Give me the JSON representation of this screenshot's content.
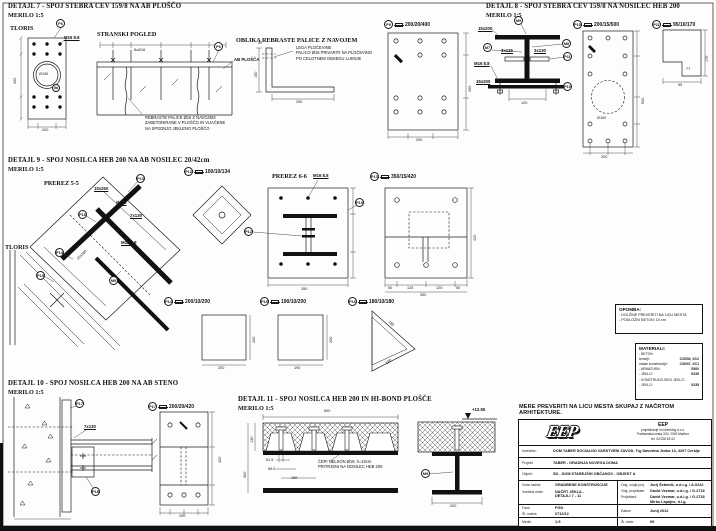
{
  "sheet": {
    "note_bold": "MERE PREVERITI NA LICU MESTA SKUPAJ Z NAČRTOM ARHITEKTURE.",
    "opomba": {
      "title": "OPOMBA:",
      "line1": "- DOLŽINE PREVERITI NA LICU MESTA",
      "line2": "- PODLOŽNI BETON: 10 cm"
    },
    "materiali": {
      "title": "MATERIALI:",
      "rows": [
        {
          "k": "- BETON",
          "v": ""
        },
        {
          "k": "temelji:",
          "v": "C25/30, XC2"
        },
        {
          "k": "ostale konstrukcije:",
          "v": "C30/37, XC1"
        },
        {
          "k": "- ARMATURA:",
          "v": "S500"
        },
        {
          "k": "- JEKLO:",
          "v": "S235"
        },
        {
          "k": "- KONSTRUKCIJSKO JEKLO:",
          "v": ""
        },
        {
          "k": "- JEKLO:",
          "v": "S235"
        }
      ]
    }
  },
  "d7": {
    "title": "DETAJL 7 - SPOJ STEBRA CEV 159/8 NA AB PLOŠČO",
    "scale": "MERILO 1:5",
    "tloris": "TLORIS",
    "stranski": "STRANSKI POGLED",
    "oblika": "OBLIKA REBRASTE PALICE Z NAVOJEM",
    "bolt": "M16 8.8",
    "cev": "Ø159",
    "bars": "8xØ16",
    "ab_plosca": "AB PLOŠČA",
    "note_rebraste": "REBRASTE PALICE Ø16 Z NAVOJEM\nZABETONIRANE V PLOŠČO IN VIJAČENE\nNA SPODNJO JEKLENO PLOŠČO",
    "note_lega": "LEGA PLOČEVINE\nPALICO Ø16 PRIVARITI NA PLOČEVINO\nPO CELOTNEM OBSEGU LUKNJE",
    "tag_p6": "P6",
    "tag_5a": "5a",
    "tag_p9": "P9",
    "p9_size": "200/20/400",
    "dim_w": "200",
    "dim_h": "400",
    "dim_250": "250",
    "dim_150": "150",
    "dim_50": "50",
    "p9_w": "200",
    "p9_h": "400"
  },
  "d8": {
    "title": "DETAJL 8 - SPOJ STEBRA CEV 159/8 NA NOSILEC HEB 200",
    "scale": "MERILO 1:5",
    "weld_top": "15x200",
    "weld_bot": "15x200",
    "s135": "3x135",
    "s130": "3x130",
    "bolt": "M16 8.8",
    "dim_120": "120",
    "tag_m9": "M9",
    "tag_m7": "M7",
    "tag_m8": "M8",
    "tag_p10": "P10",
    "tag_p11": "P11",
    "p10_size": "200/15/500",
    "p11_size": "95/10/170",
    "hole": "Ø160",
    "p10_w": "200",
    "p10_h": "500",
    "p11_w": "95",
    "p11_h": "170",
    "p11_s": "77"
  },
  "d9": {
    "title": "DETAJL 9 - SPOJ NOSILCA HEB 200 NA AB NOSILEC 20/42cm",
    "scale": "MERILO 1:5",
    "prerez55": "PREREZ 5-5",
    "tloris": "TLORIS",
    "prerez66": "PREREZ 6-6",
    "lab_10x250": "10x250",
    "lab_o150": "Ø150",
    "lab_7x130": "7x130",
    "lab_m12": "M12 8.8",
    "lab_10x160": "10x160",
    "bolt": "M16 8.8",
    "tag_p12": "P12",
    "tag_p13": "P13",
    "tag_p14": "P14",
    "tag_p15": "P15",
    "tag_p16": "P16",
    "tag_m9": "M9",
    "p12_size": "100/10/134",
    "p13_size": "350/15/420",
    "p14_size": "200/10/200",
    "p15_size": "190/10/200",
    "p16_size": "180/10/180",
    "dim66_w": "350",
    "p13_chain": [
      "50",
      "125",
      "125",
      "50"
    ],
    "p13_w": "350",
    "p13_h": "420",
    "p14_w": "200",
    "p14_h": "200",
    "p15_w": "190",
    "p15_h": "200",
    "p16_a": "180",
    "p16_b": "180"
  },
  "d10": {
    "title": "DETAJL 10 - SPOJ NOSILCA HEB 200 NA AB STENO",
    "scale": "MERILO 1:5",
    "tag_p17": "P17",
    "tag_p18": "P18",
    "lab_7x130": "7x130",
    "p17_size": "200/20/420",
    "p17_w": "200",
    "p17_h": "420"
  },
  "d11": {
    "title": "DETAJL 11 - SPOJ NOSILCA HEB 200 IN HI-BOND PLOŠČE",
    "scale": "MERILO 1:5",
    "note_cepi": "ČEPI NELSON Ø19, h=10cm\nPRITRJENI NA NOSILEC HEB 200",
    "elev": "+12.50",
    "tag_m9": "M9",
    "dim_600": "600",
    "dim_61": "61.5",
    "dim_89": "89.5",
    "dim_150": "150",
    "dim_300": "300",
    "dim_200": "200",
    "dim_130": "130"
  },
  "titleblock": {
    "logo": "EEP",
    "company": {
      "name": "EEP",
      "l1": "projektiranje in inženiring d.o.o.",
      "l2": "Partizanska cesta 3/IV, 2000 Maribor",
      "l3": "tel. 02/228 63 00"
    },
    "investitor_label": "Investitor:",
    "investitor": "DOM TABER SOCIALNO VARSTVENI ZAVOD, Trg Davorina Jenka 13, 4207 Cerklje",
    "projekt_label": "Projekt:",
    "projekt": "TABER - GRADNJA NOVEGA DOMA",
    "objekt_label": "Objekt:",
    "objekt": "SD - DOM STAREJŠIH OBČANOV - OBJEKT A",
    "vrsta_label": "Vrsta načrta:",
    "vrsta": "GRADBENE KONSTRUKCIJE",
    "vsebina_label": "Vsebina risbe:",
    "vsebina": "NAČRT JEKLA -\nDETAJLI 7 - 11",
    "odg_vodja_label": "Odg. vodja proj.",
    "odg_vodja": "Jurij Šebenik, u.d.i.g. / A-0222",
    "odg_proj_label": "Odg. projektant",
    "odg_proj": "David Vezmar, u.d.i.g. / G-2718",
    "proj_label": "Projektant",
    "proj1": "David Vezmar, u.d.i.g. / G-2718",
    "proj2": "Mirko Lapajne, d.i.g.",
    "faza_label": "Faza",
    "faza": "PGD",
    "st_label": "Št. načrta",
    "st": "0712/12",
    "datum_label": "Datum",
    "datum": "Junij 2012",
    "merilo_label": "Merilo",
    "merilo": "1:5",
    "risba_label": "Št. risbe",
    "risba": "09"
  }
}
